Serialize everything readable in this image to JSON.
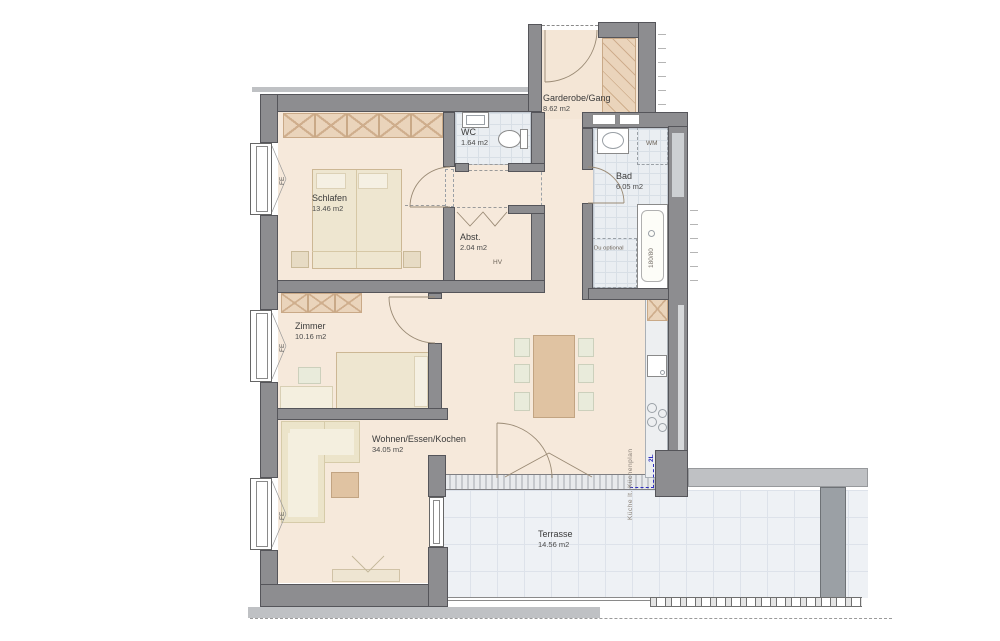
{
  "rooms": [
    {
      "name": "Schlafen",
      "area": "13.46 m2"
    },
    {
      "name": "WC",
      "area": "1.64 m2"
    },
    {
      "name": "Garderobe/Gang",
      "area": "8.62 m2"
    },
    {
      "name": "Bad",
      "area": "6.05 m2"
    },
    {
      "name": "Abst.",
      "area": "2.04 m2"
    },
    {
      "name": "Zimmer",
      "area": "10.16 m2"
    },
    {
      "name": "Wohnen/Essen/Kochen",
      "area": "34.05 m2"
    },
    {
      "name": "Terrasse",
      "area": "14.56 m2"
    }
  ],
  "annotations": {
    "window_label": "FE",
    "washing_machine": "WM",
    "shower_note": "Du optional",
    "bathtub_size": "180/80",
    "kitchen_note": "Küche lt. Küchenplan",
    "distribution_board": "HV",
    "electric_mark": "2L"
  },
  "colors": {
    "wall": "#8d8d90",
    "floor": "#f6e9db",
    "wet_room_tile": "#eaeef2",
    "terrace_tile": "#eef1f5",
    "furniture_tan": "#e0c3a2",
    "accent_blue": "#2f2fbe"
  }
}
